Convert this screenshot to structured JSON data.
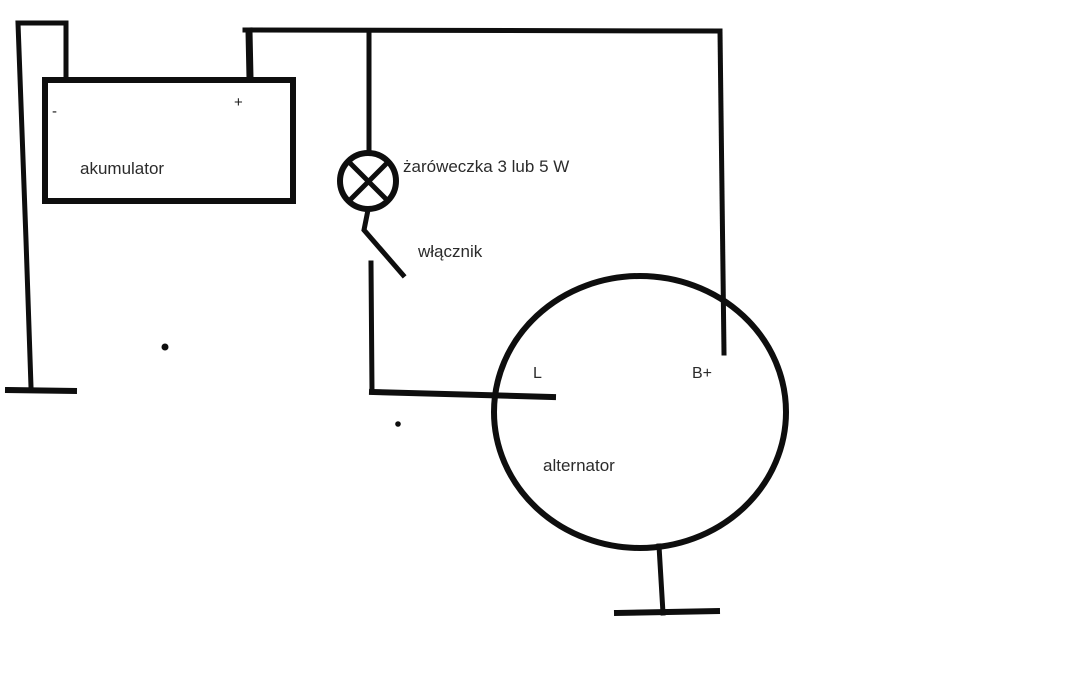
{
  "diagram": {
    "type": "circuit-schematic",
    "description": "Alternator charging circuit with battery, indicator bulb and switch",
    "labels": {
      "battery": "akumulator",
      "battery_minus": "-",
      "battery_plus": "+",
      "bulb": "żaróweczka 3 lub 5 W",
      "switch": "włącznik",
      "alternator": "alternator",
      "terminal_l": "L",
      "terminal_bplus": "B+"
    },
    "colors": {
      "line": "#0e0e0e",
      "text": "#2b2b2b",
      "background": "#ffffff"
    }
  }
}
